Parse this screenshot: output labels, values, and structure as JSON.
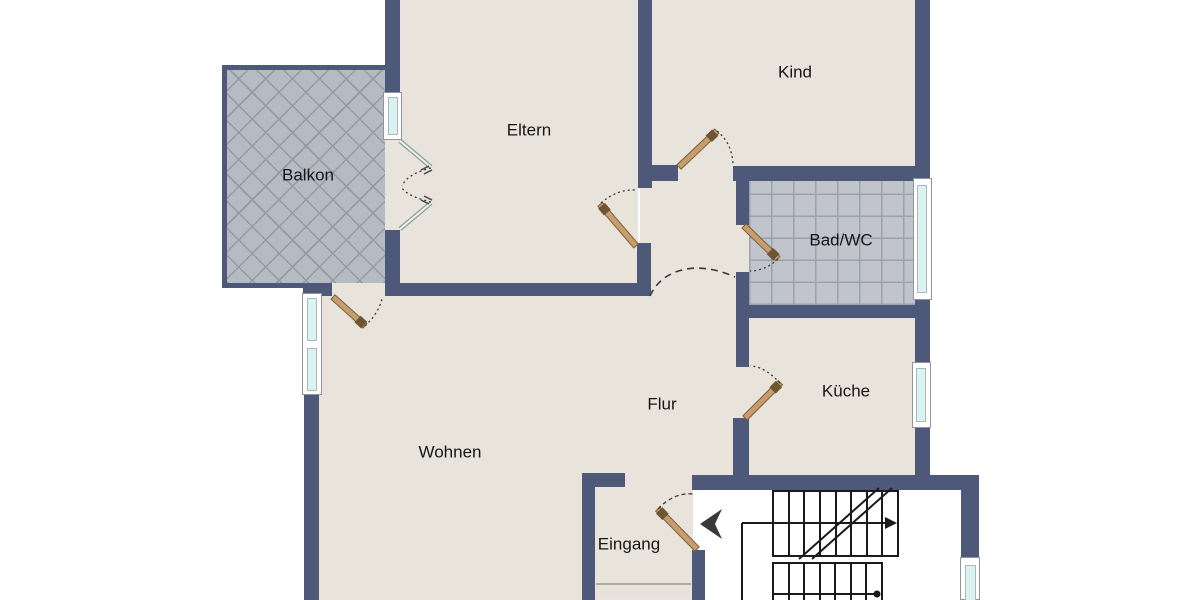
{
  "plan": {
    "type": "apartment-floor-plan",
    "rooms": {
      "balkon": {
        "label": "Balkon"
      },
      "eltern": {
        "label": "Eltern"
      },
      "kind": {
        "label": "Kind"
      },
      "bad_wc": {
        "label": "Bad/WC"
      },
      "kueche": {
        "label": "Küche"
      },
      "flur": {
        "label": "Flur"
      },
      "wohnen": {
        "label": "Wohnen"
      },
      "eingang": {
        "label": "Eingang"
      }
    },
    "icons": {
      "entrance_arrow": "entrance-direction-arrow",
      "stairs_up_arrow": "stairs-direction-arrow",
      "stairs_start_dot": "stairs-start-marker"
    },
    "colors": {
      "wall": "#4e5878",
      "floor": "#e9e4db",
      "background": "#ffffff",
      "balcony_tile": "#b6bac3",
      "balcony_grout": "#939aa6",
      "bath_tile": "#c1c4cc",
      "bath_grout": "#9ba1ad",
      "glass": "#d9f3f2",
      "frame": "#ffffff",
      "frame_edge": "#8f959b",
      "door_leaf": "#c59d6e",
      "door_edge": "#7d6038",
      "door_knob": "#6e5635",
      "line": "#1a1a1a",
      "arc": "#3a3a3a",
      "label": "#151515",
      "mat": "#e6e3dd",
      "mat_edge": "#b3ab9c",
      "french_leaf": "#eef3ee",
      "french_edge": "#8e9e96"
    }
  }
}
